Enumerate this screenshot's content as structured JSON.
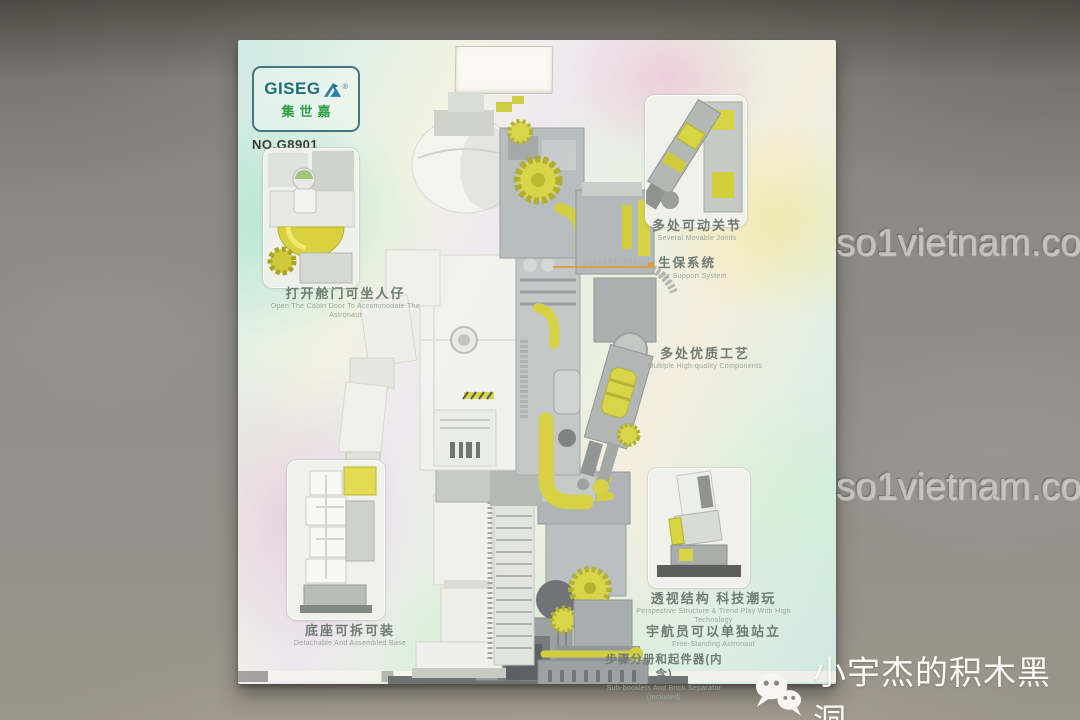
{
  "branding": {
    "logo_text": "GISEG",
    "logo_mark": "A",
    "logo_reg": "®",
    "logo_sub": "集世嘉",
    "model_no": "NO.G8901"
  },
  "features": {
    "cabin": {
      "zh": "打开舱门可坐人仔",
      "en": "Open The Cabin Door To Accommodate The Astronaut"
    },
    "joints": {
      "zh": "多处可动关节",
      "en": "Several Movable Joints"
    },
    "life_support": {
      "zh": "生保系统",
      "en": "Life Support System"
    },
    "quality": {
      "zh": "多处优质工艺",
      "en": "Multiple High-quality Components"
    },
    "base": {
      "zh": "底座可拆可装",
      "en": "Detachable And Assembled Base"
    },
    "perspective": {
      "zh": "透视结构 科技潮玩",
      "en": "Perspective Structure & Trend Play With High Technology"
    },
    "standing": {
      "zh": "宇航员可以单独站立",
      "en": "Free-Standing Astronaut"
    },
    "booklet": {
      "zh": "步骤分册和起件器(内含)",
      "en": "Sub-booklets And Brick Separator (Included)"
    }
  },
  "watermarks": {
    "site": "so1vietnam.com",
    "wechat_account": "小宇杰的积木黑洞"
  },
  "colors": {
    "accent_yellow": "#d6d23f",
    "brick_white": "#f3f3ee",
    "brick_gray": "#aeb3b5",
    "base_dark": "#54575a",
    "logo_teal": "#1f6e78",
    "logo_green": "#2f9e44",
    "pointer_orange": "#d89b3a",
    "watermark_gray": "#c9c5c0",
    "holo_pink": "#f4b2d4",
    "holo_green": "#96deb3",
    "holo_yellow": "#f2e68c"
  }
}
